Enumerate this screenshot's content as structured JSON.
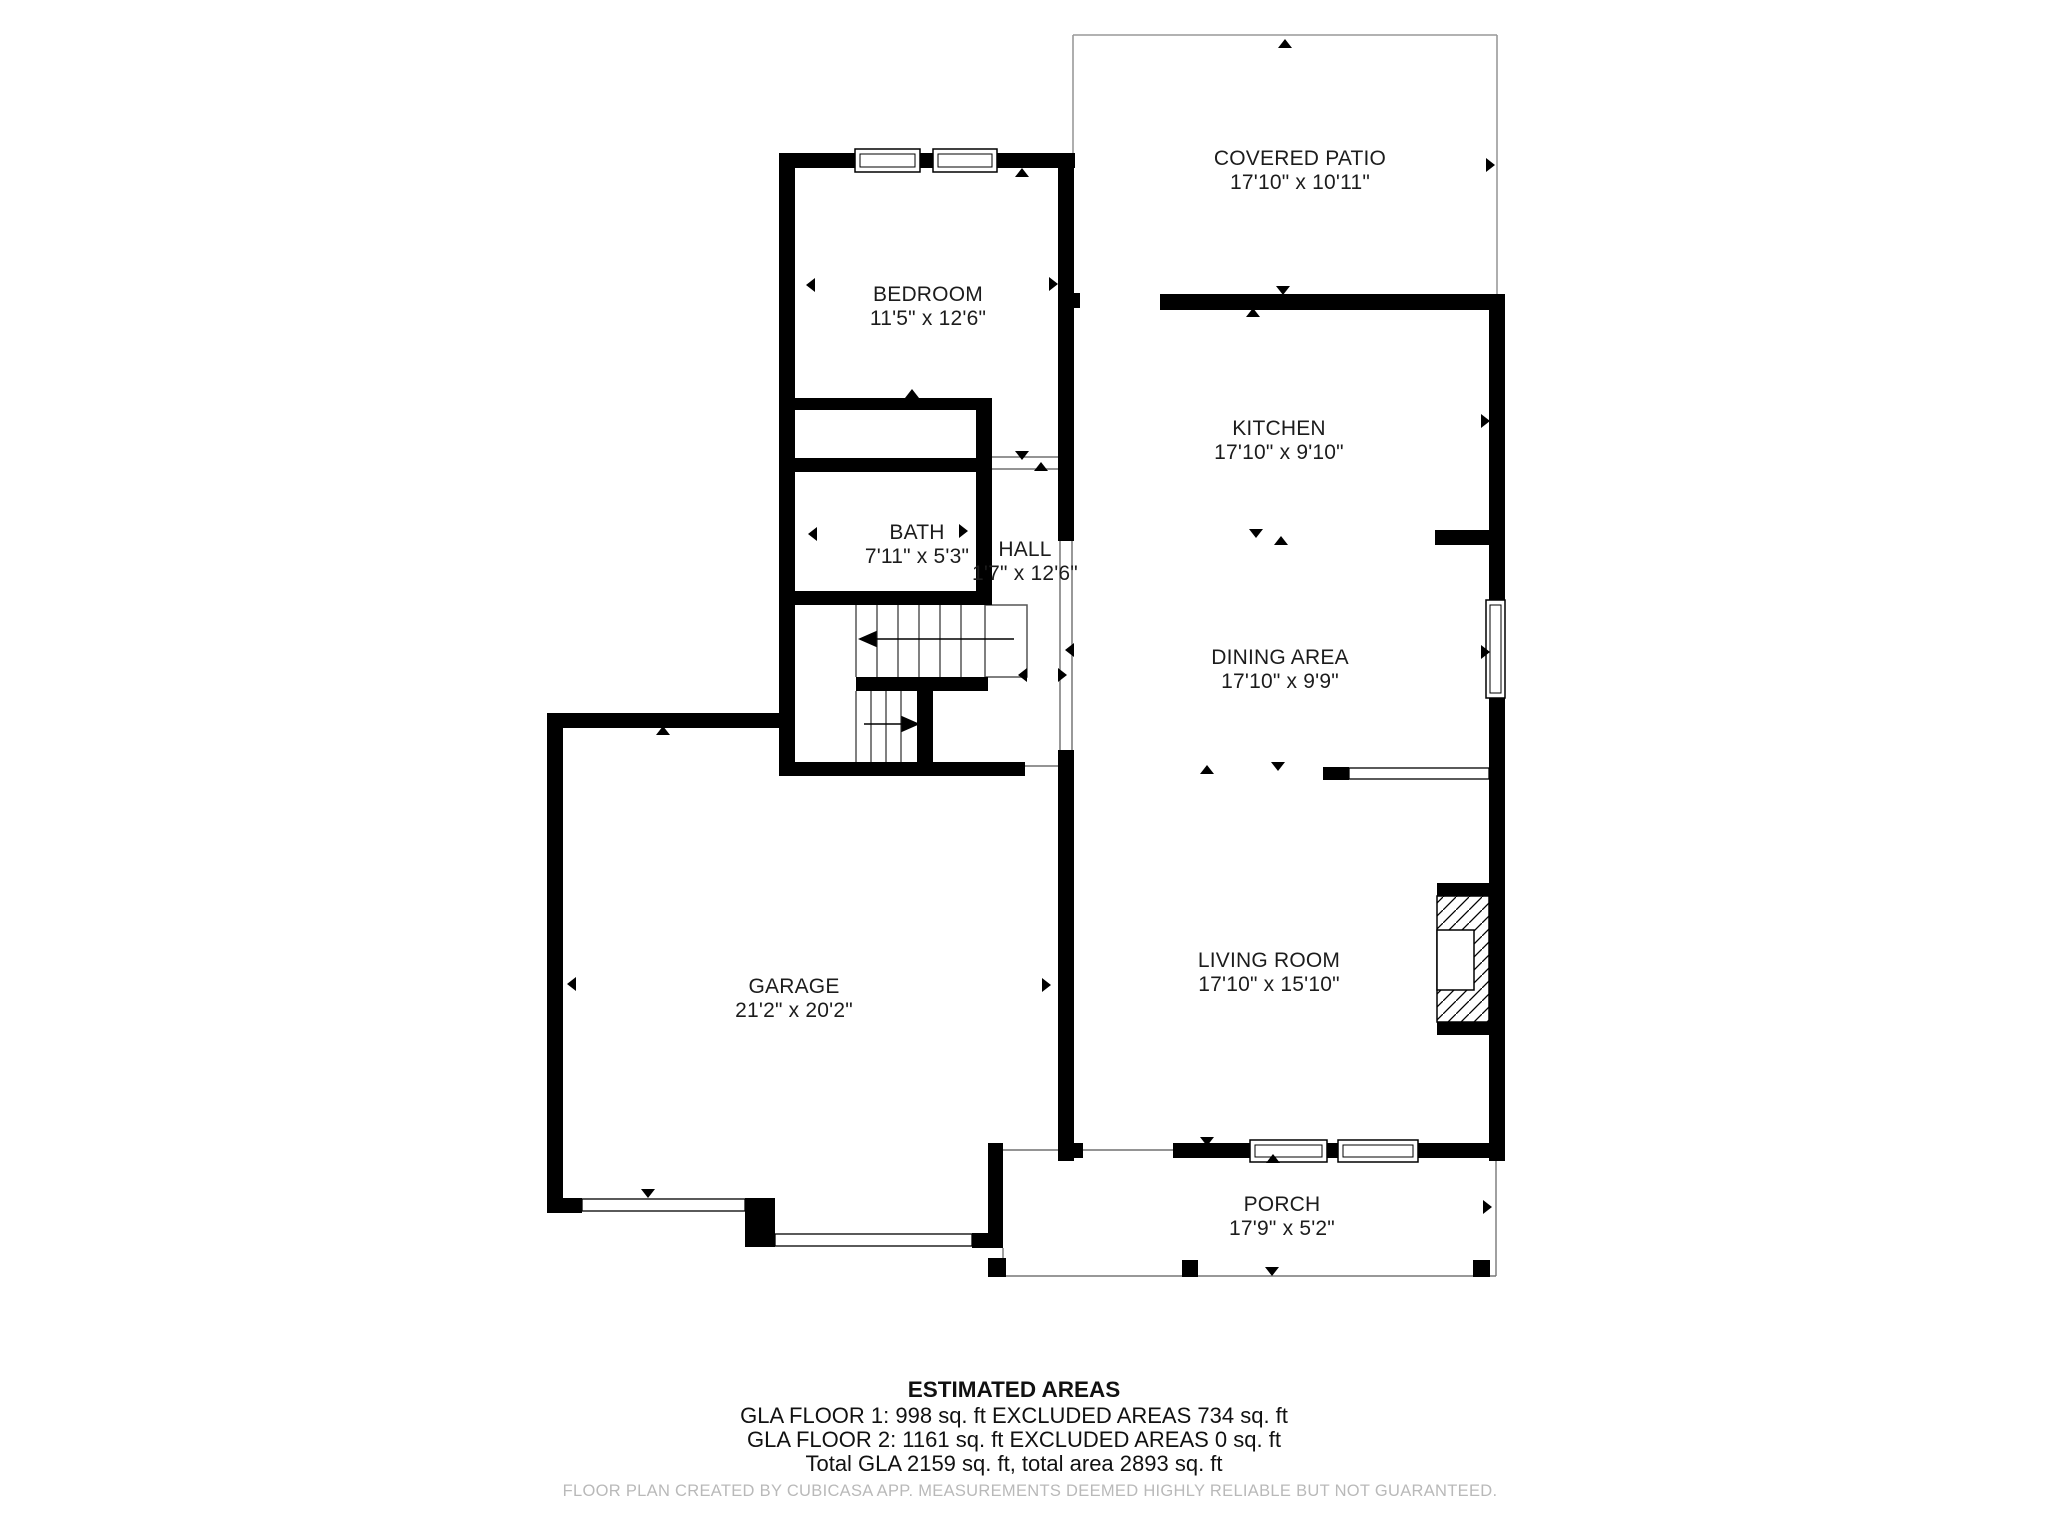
{
  "plan_colors": {
    "wall": "#000000",
    "text": "#1c1c1c",
    "open_area_line": "#999999",
    "footer_text": "#b9b9b9",
    "background": "#ffffff"
  },
  "rooms": [
    {
      "id": "covered_patio",
      "name": "COVERED PATIO",
      "dims": "17'10\" x 10'11\""
    },
    {
      "id": "bedroom",
      "name": "BEDROOM",
      "dims": "11'5\" x 12'6\""
    },
    {
      "id": "kitchen",
      "name": "KITCHEN",
      "dims": "17'10\" x 9'10\""
    },
    {
      "id": "bath",
      "name": "BATH",
      "dims": "7'11\" x 5'3\""
    },
    {
      "id": "hall",
      "name": "HALL",
      "dims": "1'7\" x 12'6\""
    },
    {
      "id": "dining_area",
      "name": "DINING AREA",
      "dims": "17'10\" x 9'9\""
    },
    {
      "id": "garage",
      "name": "GARAGE",
      "dims": "21'2\" x 20'2\""
    },
    {
      "id": "living_room",
      "name": "LIVING ROOM",
      "dims": "17'10\" x 15'10\""
    },
    {
      "id": "porch",
      "name": "PORCH",
      "dims": "17'9\" x 5'2\""
    }
  ],
  "estimated_areas": {
    "title": "ESTIMATED AREAS",
    "lines": [
      "GLA FLOOR 1: 998 sq. ft EXCLUDED AREAS 734 sq. ft",
      "GLA FLOOR 2: 1161 sq. ft EXCLUDED AREAS 0 sq. ft",
      "Total GLA 2159 sq. ft, total area 2893 sq. ft"
    ]
  },
  "footer": "FLOOR PLAN CREATED BY CUBICASA APP. MEASUREMENTS DEEMED HIGHLY RELIABLE BUT NOT GUARANTEED."
}
